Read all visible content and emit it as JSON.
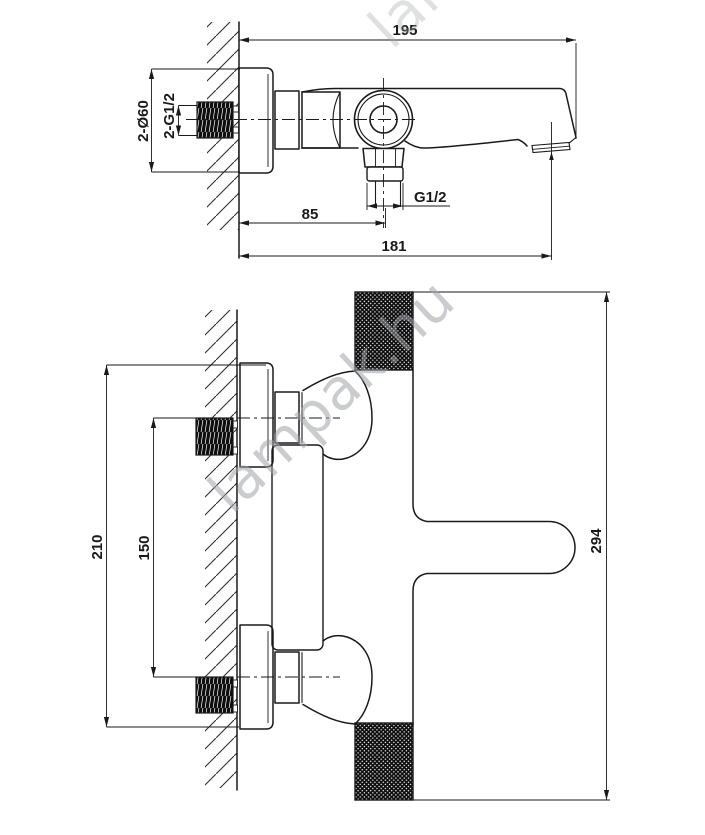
{
  "page": {
    "background": "#ffffff",
    "line_color": "#1a1a1a",
    "watermark_color": "#9ea3a8"
  },
  "watermark": {
    "text": "lampak.hu"
  },
  "side_view": {
    "title": "bath mixer side view",
    "dims": {
      "total_depth": "195",
      "escutcheon_diameter": "2-Ø60",
      "inlet_thread": "2-G1/2",
      "spout_offset": "85",
      "spout_reach": "181",
      "hose_thread": "G1/2"
    }
  },
  "plan_view": {
    "title": "bath mixer plan view",
    "dims": {
      "mounting_span": "210",
      "inlet_distance": "150",
      "overall_length": "294"
    }
  }
}
